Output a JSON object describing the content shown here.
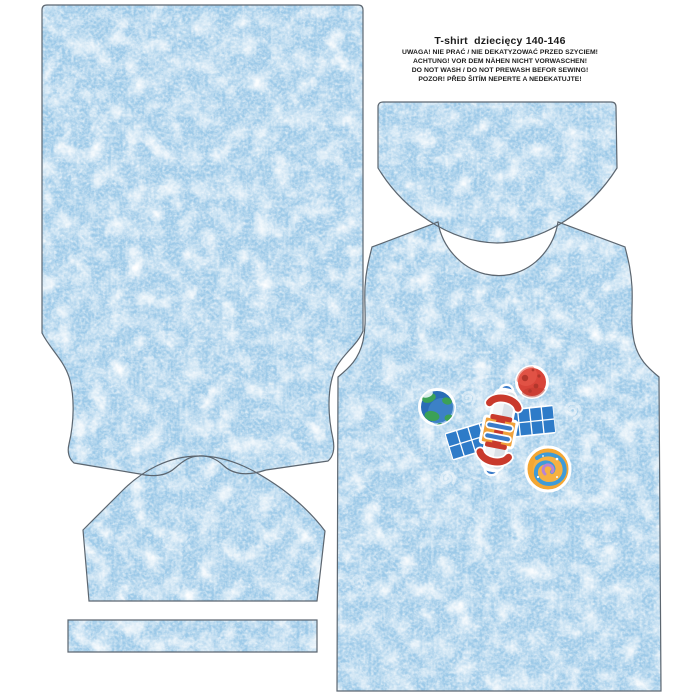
{
  "header": {
    "title": "T-shirt  dziecięcy 140-146",
    "warnings": [
      "UWAGA! NIE PRAĆ / NIE DEKATYZOWAĆ PRZED SZYCIEM!",
      "ACHTUNG! VOR DEM NÄHEN NICHT VORWASCHEN!",
      "DO NOT WASH / DO NOT PREWASH BEFOR SEWING!",
      "POZOR! PŘED ŠITÍM NEPERTE A NEDEKATUJTE!"
    ]
  },
  "pieces": [
    "back-panel",
    "front-panel-with-print",
    "neck-facing",
    "sleeve",
    "hem-band"
  ],
  "print_motifs": [
    "satellite-icon",
    "earth-icon",
    "red-planet-icon",
    "spiral-galaxy-icon",
    "swirl-decoration"
  ],
  "colors": {
    "background": "#ffffff",
    "fabric_base": "#9cc9e8",
    "outline": "#5c6670",
    "text": "#1c1c1c",
    "panel_blue": "#2e7bc8",
    "satellite_red": "#c93a2c",
    "satellite_orange": "#f0a13a",
    "satellite_blue": "#3a7bc8",
    "earth_ocean": "#2a6db6",
    "earth_land": "#3ba157",
    "planet_red": "#d8453a",
    "galaxy_orange": "#f4a733",
    "galaxy_spiral_blue": "#3e9bd8",
    "galaxy_spiral_purple": "#b983d4"
  }
}
